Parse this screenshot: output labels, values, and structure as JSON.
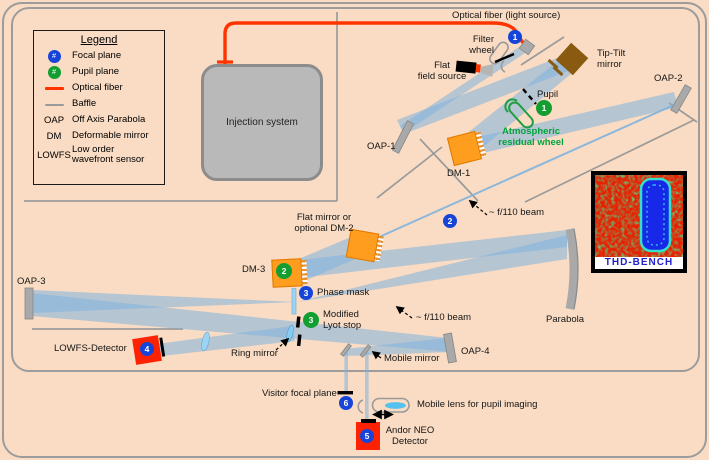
{
  "legend": {
    "title": "Legend",
    "focal": {
      "symbol_num": "#",
      "label": "Focal plane"
    },
    "pupil": {
      "symbol_num": "#",
      "label": "Pupil plane"
    },
    "fiber": {
      "label": "Optical fiber"
    },
    "baffle": {
      "label": "Baffle"
    },
    "oap": {
      "term": "OAP",
      "def": "Off Axis Parabola"
    },
    "dm": {
      "term": "DM",
      "def": "Deformable mirror"
    },
    "lowfs": {
      "term": "LOWFS",
      "def": "Low order\nwavefront sensor"
    }
  },
  "labels": {
    "optical_fiber": "Optical fiber (light source)",
    "filter_wheel": "Filter\nwheel",
    "flat_field_source": "Flat\nfield source",
    "tip_tilt": "Tip-Tilt\nmirror",
    "oap2": "OAP-2",
    "oap1": "OAP-1",
    "dm1": "DM-1",
    "pupil": "Pupil",
    "atmospheric_wheel": "Atmospheric\nresidual wheel",
    "injection": "Injection system",
    "flat_dm2": "Flat mirror or\noptional DM-2",
    "f110_upper": "~ f/110 beam",
    "dm3": "DM-3",
    "phase_mask": "Phase mask",
    "lyot": "Modified\nLyot stop",
    "f110_lower": "~ f/110 beam",
    "parabola": "Parabola",
    "oap3": "OAP-3",
    "lowfs_detector": "LOWFS-Detector",
    "ring_mirror": "Ring mirror",
    "mobile_mirror": "Mobile mirror",
    "oap4": "OAP-4",
    "visitor_focal": "Visitor focal plane",
    "mobile_lens": "Mobile lens for pupil imaging",
    "andor": "Andor NEO\nDetector",
    "thd_caption": "THD-BENCH"
  },
  "markers": {
    "focal": [
      "1",
      "2",
      "3",
      "4",
      "5",
      "6"
    ],
    "pupil": [
      "1",
      "2",
      "3"
    ]
  },
  "colors": {
    "background": "#F9DCC3",
    "focal_plane_blue": "#1644D9",
    "pupil_plane_green": "#129E30",
    "optical_fiber_red": "#FF3300",
    "beam_blue": "#7FB2DE",
    "dm_orange": "#FF9D1E",
    "detector_red": "#FF2200",
    "tip_tilt_brown": "#8A5A10",
    "wheel_green_text": "#00A33C",
    "border_gray": "#9c9c9c"
  }
}
